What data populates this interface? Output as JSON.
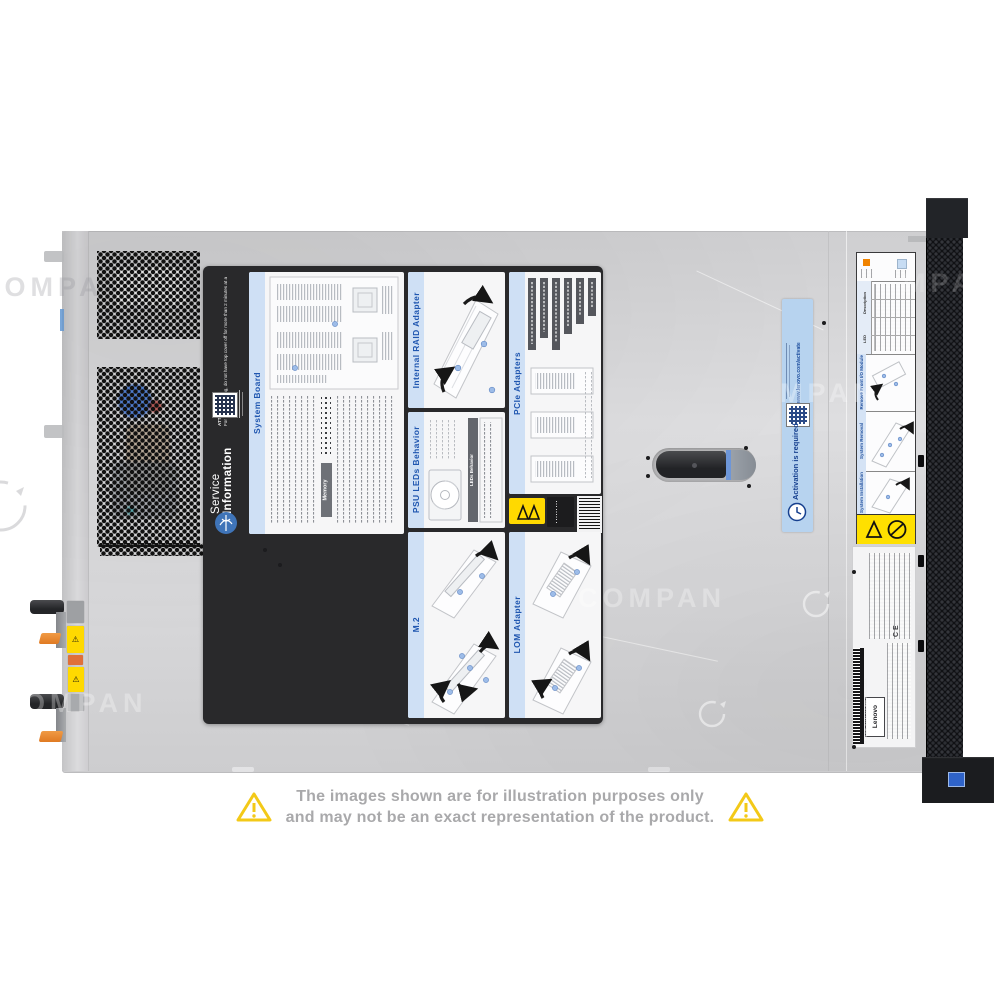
{
  "watermark": {
    "instances": [
      "COMPA",
      "COMPAN",
      "OMPAN",
      "MPAN",
      "MPAN"
    ]
  },
  "disclaimer": {
    "line1": "The images shown are for illustration purposes only",
    "line2": "and may not be an exact representation of the product."
  },
  "service_label": {
    "sidebar": {
      "title_line1": "Service",
      "title_line2": "Information",
      "attention_heading": "ATTENTION:",
      "attention_body": "For proper cooling, do not have top cover off for more than 2 minutes at a time while the system is running."
    },
    "panels": {
      "system_board": {
        "title": "System Board",
        "memory_header": "Memory"
      },
      "internal_raid": {
        "title": "Internal RAID Adapter"
      },
      "pcie": {
        "title": "PCIe Adapters"
      },
      "psu_leds": {
        "title": "PSU LEDs Behavior",
        "table_header": "LEDs Behavior"
      },
      "m2": {
        "title": "M.2"
      },
      "lom": {
        "title": "LOM Adapter"
      }
    }
  },
  "activation_sticker": {
    "title": "Activation is required",
    "url": "www.lenovo.com/activate"
  },
  "front_strip_label": {
    "table": {
      "col_led": "LED",
      "col_description": "Description"
    },
    "sections": [
      {
        "title": "Remove Front I/O Module"
      },
      {
        "title": "System Removal"
      },
      {
        "title": "System Installation"
      }
    ]
  },
  "regulatory_label": {
    "brand": "Lenovo",
    "marks": "CE",
    "barcode_text": "MTM-S/N 7D2XCTO1WW SAAV06898"
  },
  "colors": {
    "chassis_gray": "#d6d6d8",
    "label_title_blue": "#1f56b0",
    "activation_blue": "#b7d3ef",
    "warning_yellow": "#ffd900",
    "latch_orange": "#e8832a"
  }
}
